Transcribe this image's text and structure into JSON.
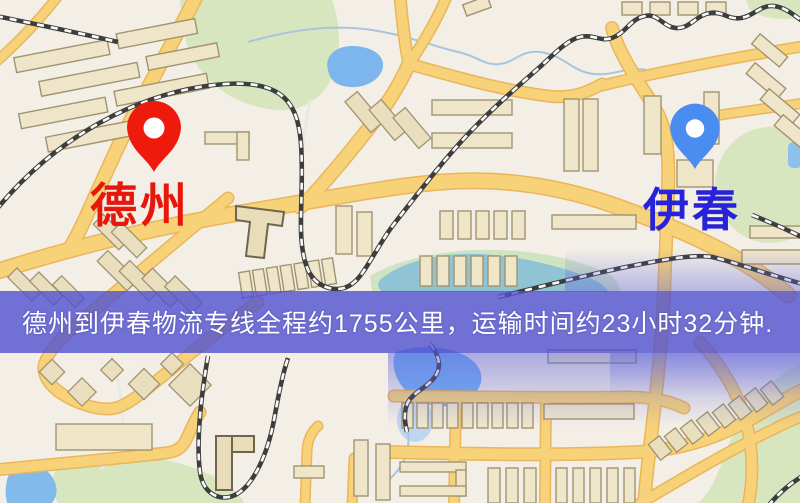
{
  "map": {
    "origin": {
      "label": "德州",
      "pin_color": "#ee1a0c",
      "label_color": "#e8170c"
    },
    "destination": {
      "label": "伊春",
      "pin_color": "#4b8cf0",
      "label_color": "#2822d8"
    }
  },
  "banner": {
    "text": "德州到伊春物流专线全程约1755公里，运输时间约23小时32分钟.",
    "background_color": "#5050cf",
    "text_color": "#ffffff"
  },
  "route": {
    "distance_km": "1755",
    "duration_hours": "23",
    "duration_minutes": "32"
  },
  "palette": {
    "map_background": "#f3efe6",
    "road_fill": "#f7d278",
    "road_casing": "#e9b65b",
    "water": "#7cb6ed",
    "park": "#d8e6c0",
    "building_fill": "#efe6ca",
    "railway": "#3d3d3d"
  }
}
